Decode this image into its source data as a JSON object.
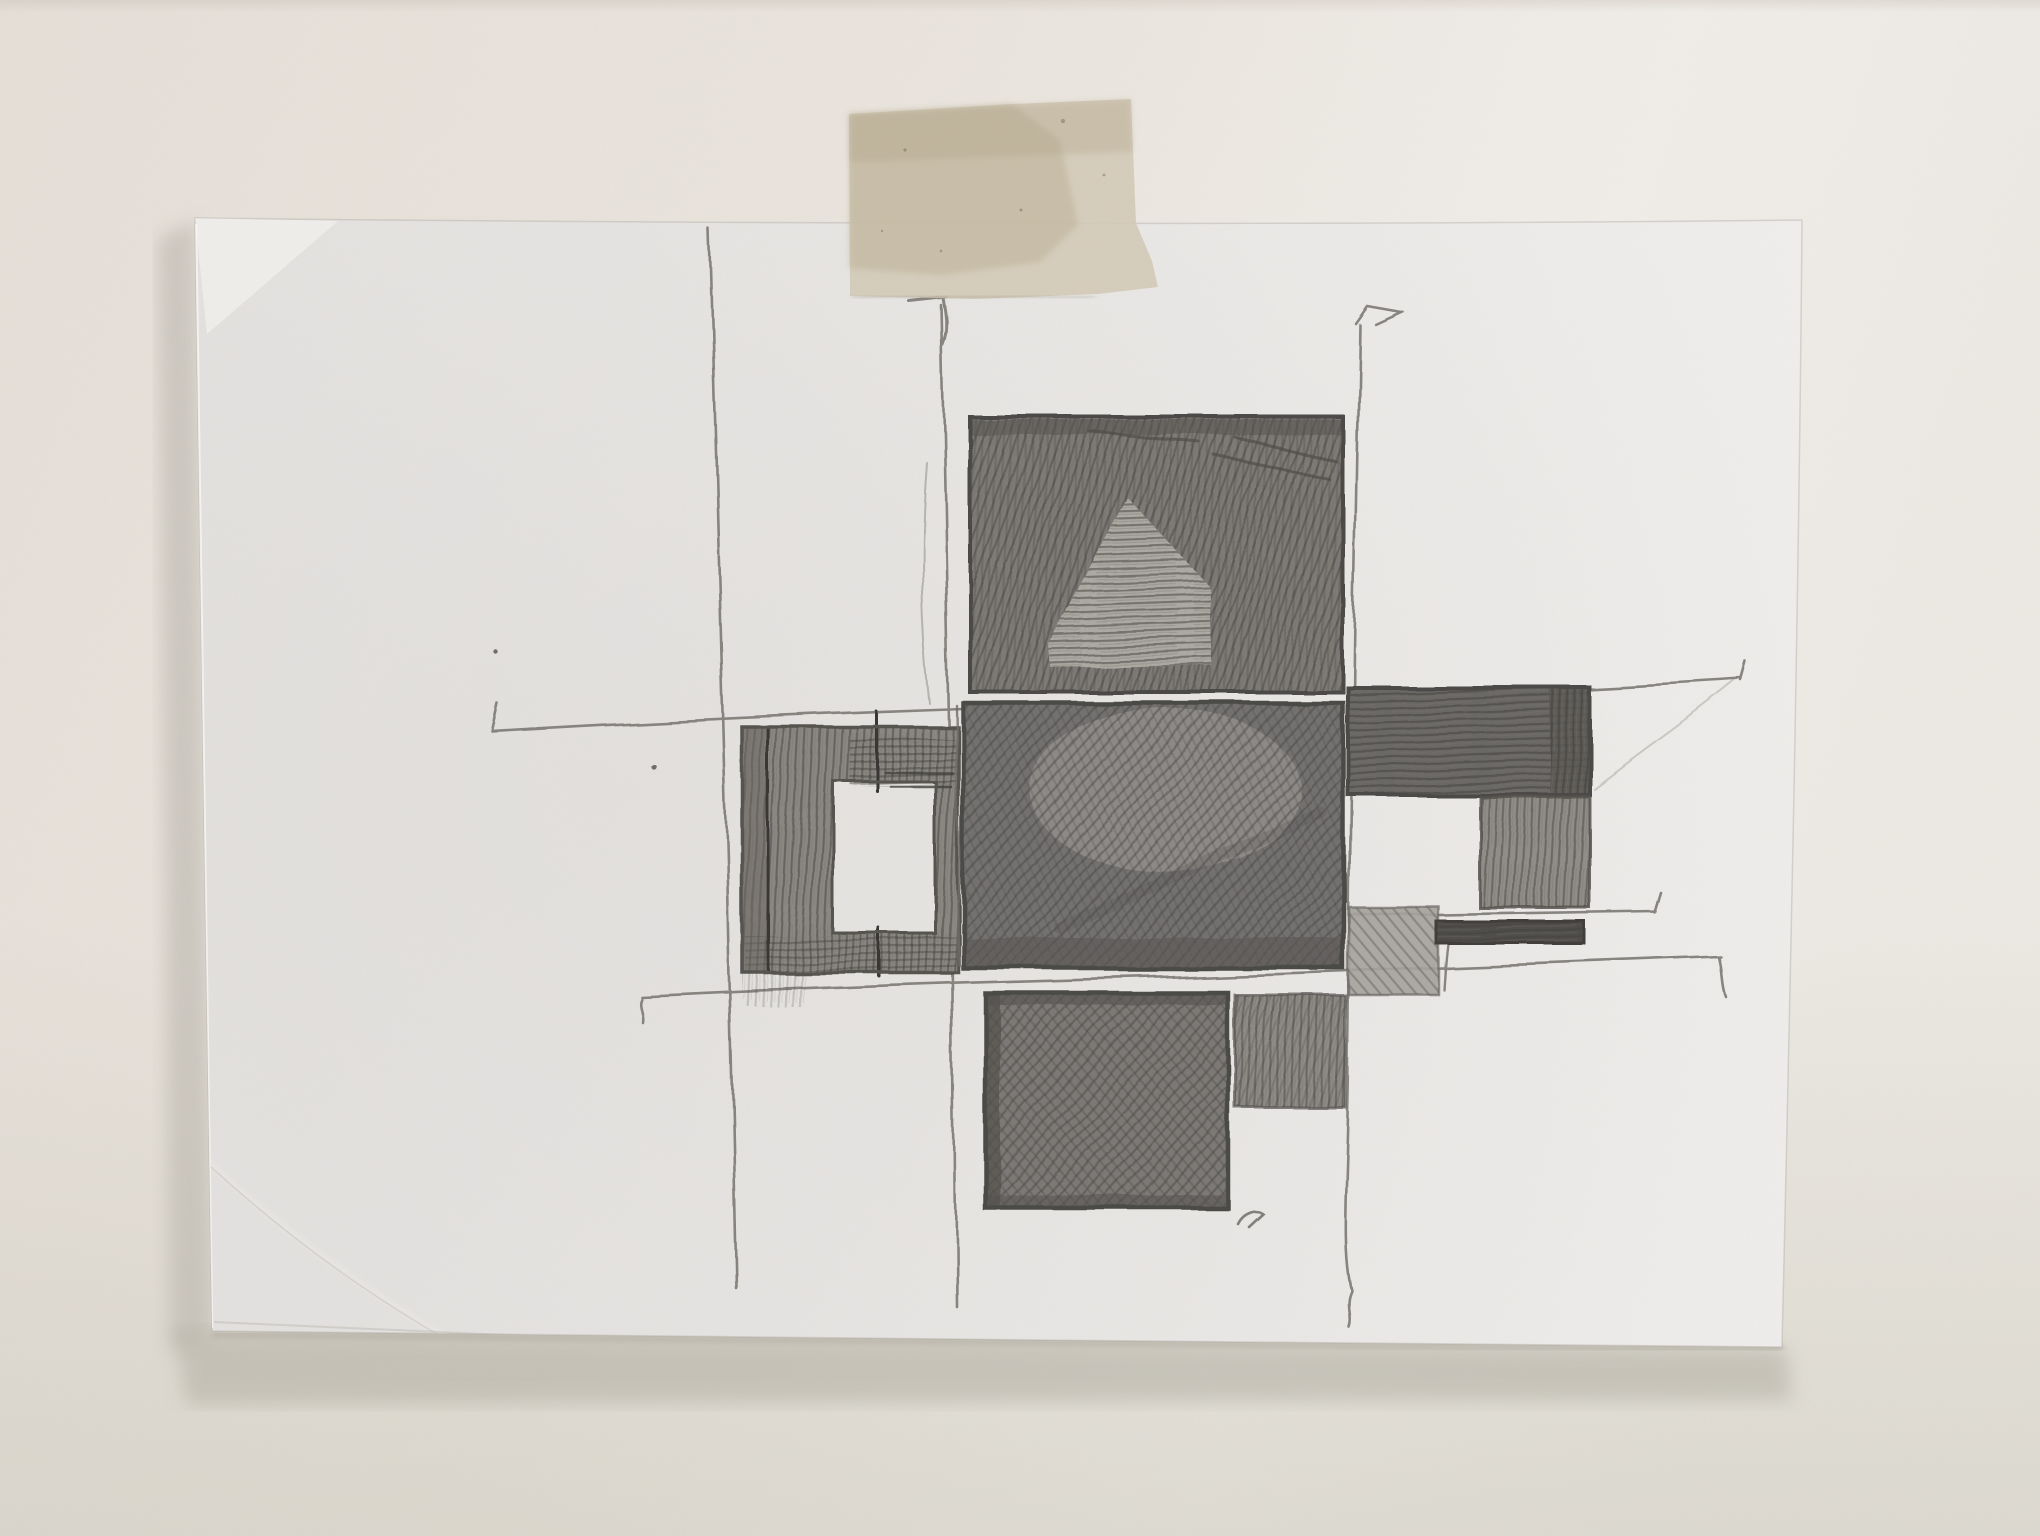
{
  "scene": {
    "title": "Pencil sketch on white paper taped to a wall",
    "description": "Photograph of a hand-drawn graphite study: a cross-shaped cluster of shaded rectangles (one with a hollow centre) connected by long wavy construction lines with hooked tick ends, drawn on a white sheet fixed to a pale wall by one piece of masking tape at the top centre.",
    "medium": "graphite pencil on paper",
    "objects": [
      "wall",
      "paper-sheet",
      "masking-tape",
      "pencil-sketch"
    ]
  },
  "palette": {
    "wall_top_left": "#e6e0d9",
    "wall_top_right": "#f0ede8",
    "wall_bottom": "#dbd8cf",
    "wall_shadow": "#b3afa4",
    "paper_base": "#e9e7e5",
    "paper_light": "#efedeb",
    "paper_dark": "#e2e0dd",
    "tape_base": "#d4ccba",
    "tape_dark": "#c2b9a4",
    "tape_light": "#ddd6c6",
    "pencil_line": "#7d7a74",
    "pencil_dark": "#3e3c39"
  },
  "paper": {
    "label": "white paper sheet, slightly tilted, lit from the right, soft shadow lower-left",
    "corner_fold": "small flattened fold at top-left corner",
    "stacked_edge": "layered sheet edge visible along bottom-left"
  },
  "tape": {
    "label": "single strip of beige masking tape crossing the top edge of the paper",
    "torn_edge": "torn diagonal lower-right corner"
  },
  "sketch": {
    "blocks": [
      {
        "id": "top-square",
        "label": "large square, dense steep diagonal hatching with lighter horizontal fan at centre-bottom",
        "base": "#7d7a76"
      },
      {
        "id": "center-square",
        "label": "large central square, darkest multidirectional scribble with lighter sheen upper-right",
        "base": "#737070"
      },
      {
        "id": "left-ring-square",
        "label": "square frame with blank paper window, vertical strokes and dark accent lines",
        "base": "#8a8783"
      },
      {
        "id": "right-top-bar",
        "label": "wide bar of dense horizontal strokes with darker right column",
        "base": "#6b6865"
      },
      {
        "id": "right-middle-block",
        "label": "medium block of vertical strokes hanging below the bar",
        "base": "#908d89"
      },
      {
        "id": "right-small-block",
        "label": "small lightly hatched block at lower left of right group",
        "base": "#a5a29d"
      },
      {
        "id": "right-dark-bar",
        "label": "thin very dark horizontal bar",
        "base": "#504e4b"
      },
      {
        "id": "bottom-large-square",
        "label": "large square of dense cross-diagonal hatching, dark left edge",
        "base": "#7b7874"
      },
      {
        "id": "bottom-small-square",
        "label": "smaller medium-toned square right of the large one",
        "base": "#8e8b86"
      }
    ],
    "construction_lines": [
      {
        "id": "vertical-left",
        "label": "long wavy vertical line, left"
      },
      {
        "id": "vertical-center",
        "label": "long vertical line with hooked top"
      },
      {
        "id": "vertical-right",
        "label": "long vertical line with small flag at top and curled tail"
      },
      {
        "id": "horizontal-upper",
        "label": "long horizontal line with end ticks, above the middle row"
      },
      {
        "id": "horizontal-lower",
        "label": "long horizontal line with hooked ends, below the middle row"
      },
      {
        "id": "horizontal-right-short",
        "label": "short horizontal line under right-hand blocks"
      }
    ],
    "marks": [
      "tiny check mark below bottom square",
      "two small pencil dots on left half"
    ]
  }
}
